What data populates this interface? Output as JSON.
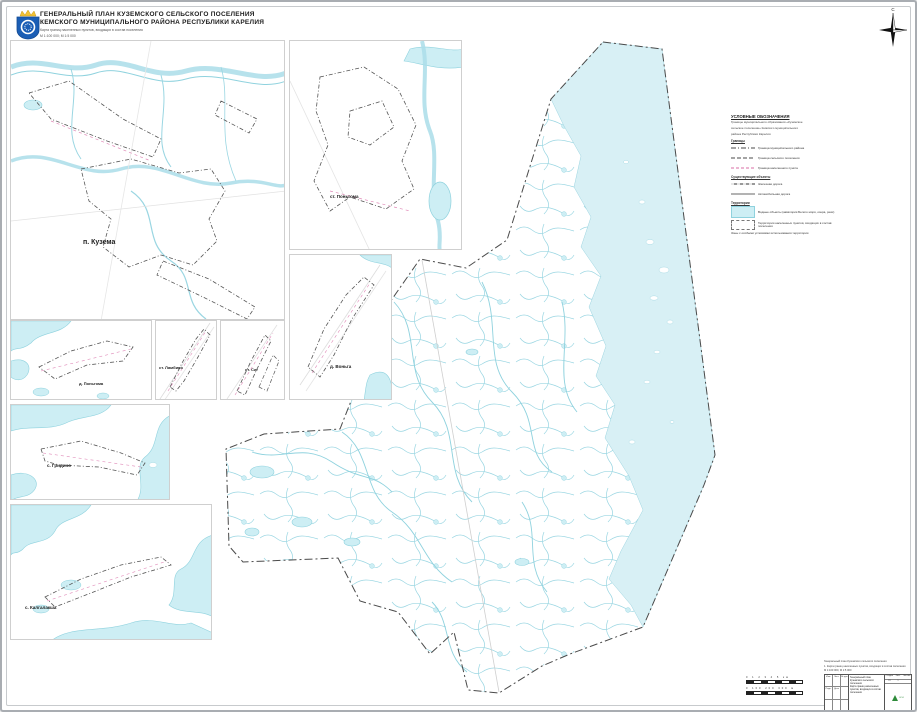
{
  "page": {
    "title_line1": "ГЕНЕРАЛЬНЫЙ ПЛАН КУЗЕМСКОГО СЕЛЬСКОГО ПОСЕЛЕНИЯ",
    "title_line2": "КЕМСКОГО МУНИЦИПАЛЬНОГО РАЙОНА РЕСПУБЛИКИ КАРЕЛИЯ",
    "subtitle_line1": "Карта границ населенных пунктов, входящих в состав поселения",
    "subtitle_line2": "М 1:100 000; М 1:5 000",
    "north_label": "С"
  },
  "legend": {
    "title": "УСЛОВНЫЕ ОБОЗНАЧЕНИЯ",
    "intro_line1": "Границы муниципального образования «Куземское",
    "intro_line2": "сельское поселение» Кемского муниципального",
    "intro_line3": "района Республики Карелия",
    "section1": "Границы",
    "section2": "Существующие объекты",
    "section3": "Территории",
    "items": [
      {
        "symbol": "dash-dot",
        "label": "Граница муниципального района"
      },
      {
        "symbol": "dashed",
        "label": "Граница сельского поселения"
      },
      {
        "symbol": "dash-pink",
        "label": "Граница населенного пункта"
      },
      {
        "symbol": "railway",
        "label": "Железная дорога"
      },
      {
        "symbol": "road",
        "label": "Автомобильная дорога"
      },
      {
        "symbol": "water",
        "label": "Водные объекты (акватория Белого моря, озера, реки)"
      },
      {
        "symbol": "np-area",
        "label": "Территории населенных пунктов, входящих в состав поселения"
      },
      {
        "symbol": "none",
        "label": "Зоны с особыми условиями использования территории"
      }
    ]
  },
  "insets": [
    {
      "id": "kuzema",
      "label": "п. Кузема"
    },
    {
      "id": "st-pongoma",
      "label": "ст. Поньгома"
    },
    {
      "id": "vonga",
      "label": "д. Воньга"
    },
    {
      "id": "d-pongoma",
      "label": "д. Поньгома"
    },
    {
      "id": "lambino",
      "label": "ст. Ламбино"
    },
    {
      "id": "sig",
      "label": "ст. Сиг"
    },
    {
      "id": "gridino",
      "label": "с. Гридино"
    },
    {
      "id": "kalgalaksha",
      "label": "с. Калгалакша"
    }
  ],
  "scalebars": {
    "bar1_ticks": "0 1 2 3 4 5 км",
    "bar2_ticks": "0 100 200 300 м"
  },
  "stamp": {
    "note_line1": "Генеральный план Куземского сельского поселения",
    "note_line2": "1. Карта границ населенных пунктов, входящих в состав поселения",
    "note_line3": "М 1:100 000, М 1:5 000",
    "col_izm": "Изм.",
    "col_list": "Лист",
    "col_dok": "№ док.",
    "col_podp": "Подп.",
    "col_data": "Дата",
    "doc_line1": "Генеральный план Куземского сельского поселения",
    "doc_line2": "Карта границ населенных пунктов, входящих в состав поселения",
    "stage_label": "Стадия",
    "sheet_label": "Лист",
    "sheets_label": "Листов",
    "stage_value": "ГП",
    "sheet_value": "1",
    "logo_text": "ООО"
  },
  "colors": {
    "water_fill": "#cdeef4",
    "sea_fill": "#d8f0f5",
    "water_line": "#8fd2de",
    "boundary": "#4a4a4a",
    "np_boundary_pink": "#e08ab8",
    "emblem_blue": "#1b5eb5",
    "crown_gold": "#f2c233"
  }
}
